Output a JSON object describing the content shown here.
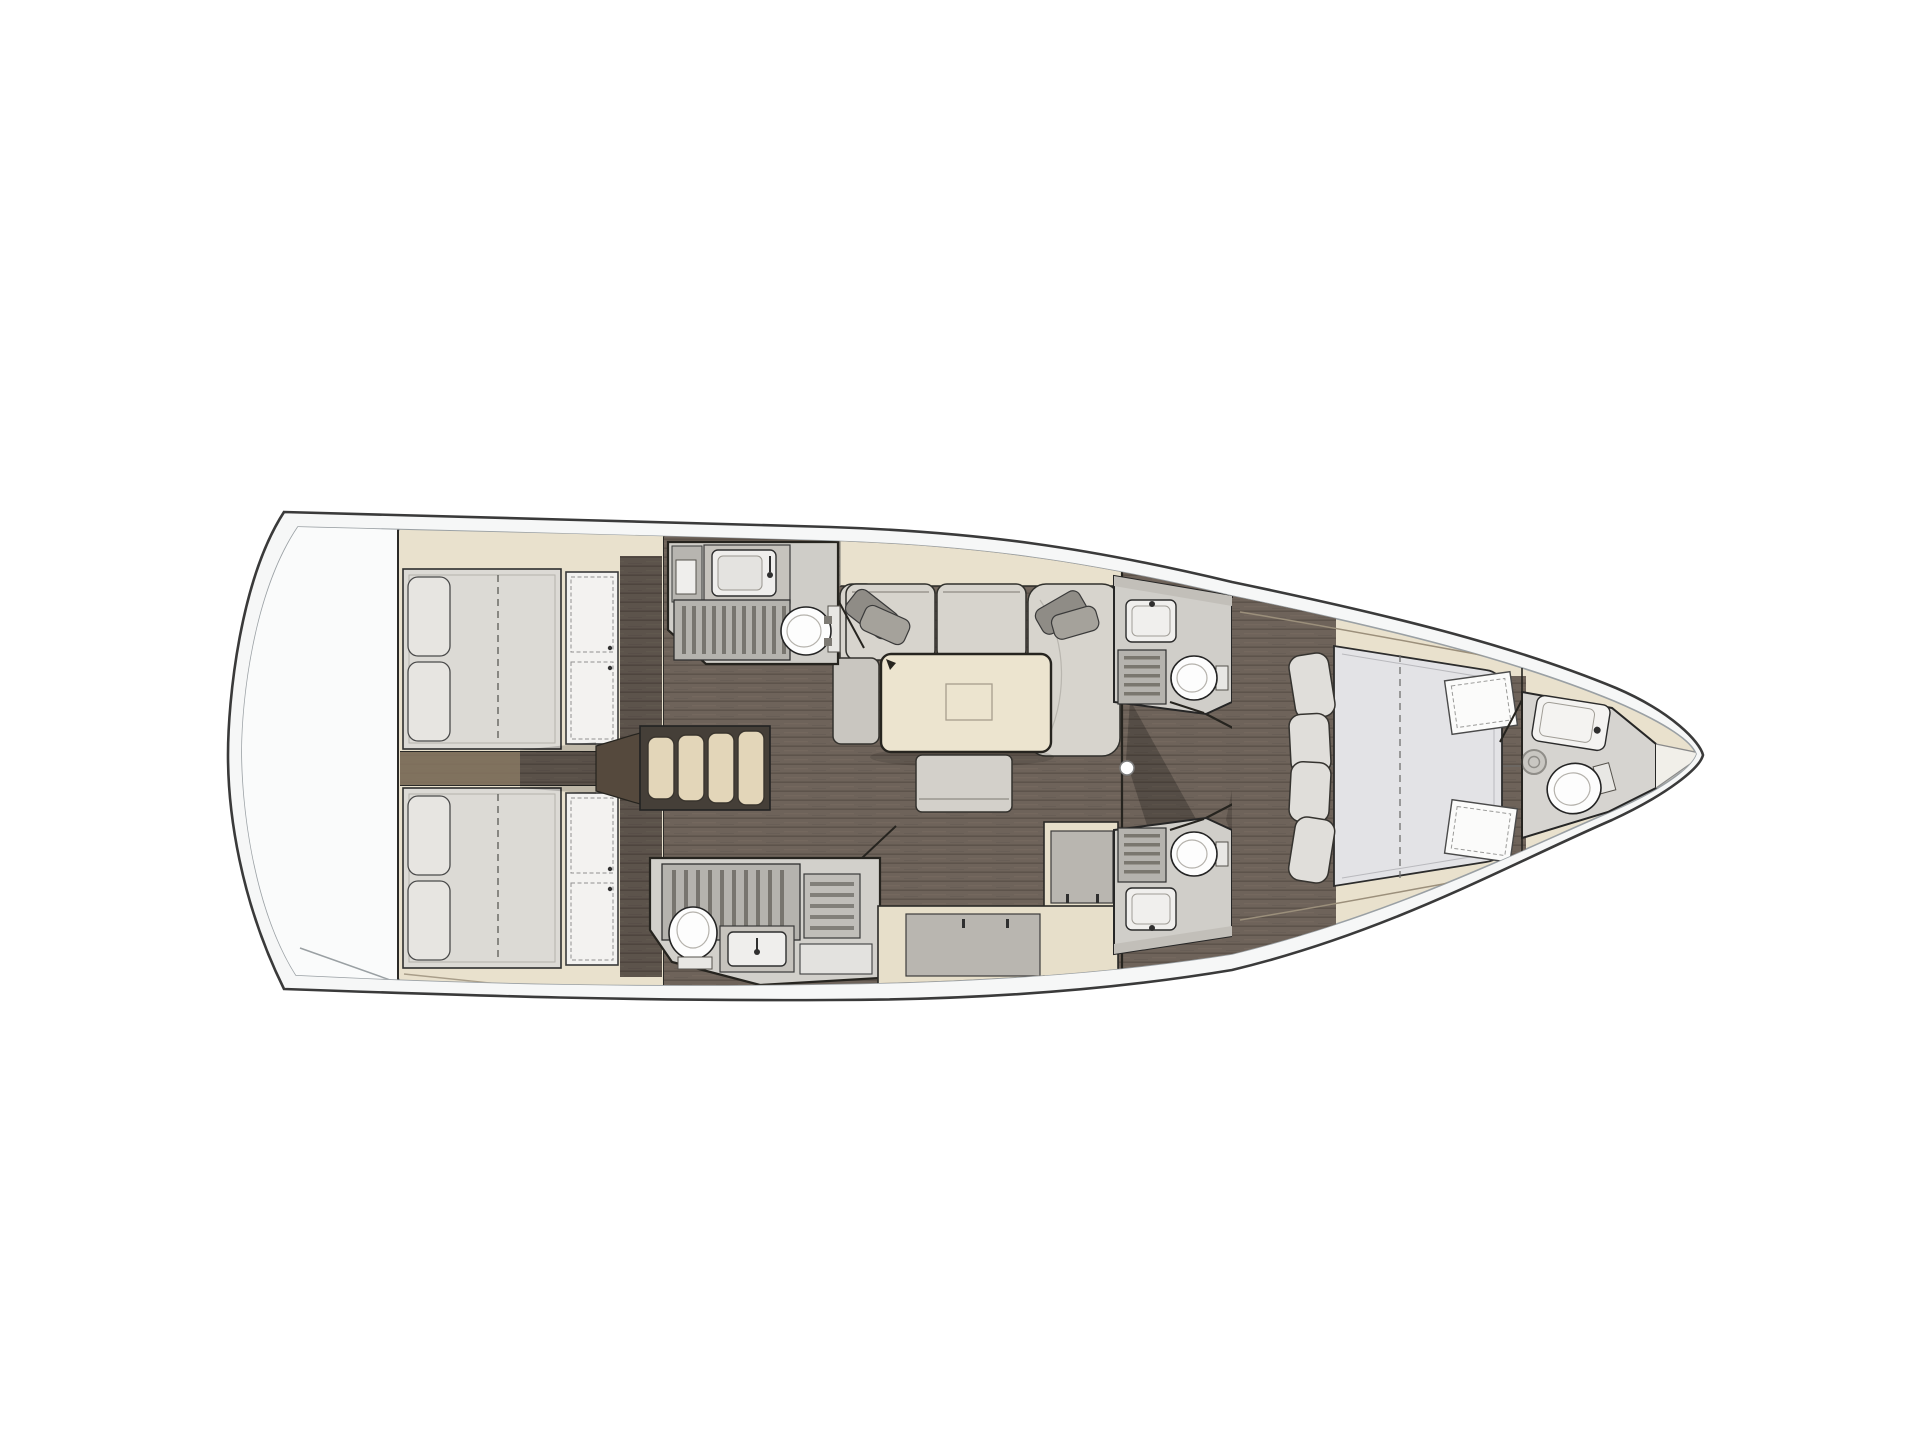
{
  "title": "Sailing yacht interior layout plan, top-down deck view, bow pointing right",
  "palette": {
    "hull_stroke": "#3a3a3a",
    "deck_band": "#f6f7f7",
    "joinery_beige": "#e9e1cd",
    "wood_floor": "#6e635a",
    "mattress_gray": "#dcdad5",
    "forward_mattress": "#e3e3e6",
    "sofa_fabric": "#d7d4cd",
    "table_top": "#ece4cf",
    "companionway_steps": "#e3d6b9",
    "shower_grate": "#b5b3ae",
    "sanitary_white": "#fdfdfd",
    "counter_gray": "#c3c0ba",
    "appliance_gray": "#b9b6b0"
  },
  "rooms": [
    {
      "id": "stern-lazarette",
      "label": "Stern / transom locker",
      "furniture": []
    },
    {
      "id": "aft-cabin-starboard",
      "label": "Aft double cabin, starboard",
      "furniture": [
        "double berth",
        "pillows",
        "wardrobe lockers"
      ]
    },
    {
      "id": "aft-cabin-port",
      "label": "Aft double cabin, port",
      "furniture": [
        "double berth",
        "pillows",
        "wardrobe lockers"
      ]
    },
    {
      "id": "companionway",
      "label": "Companionway steps",
      "furniture": [
        "four steps"
      ]
    },
    {
      "id": "aft-head-starboard",
      "label": "Aft head, starboard",
      "furniture": [
        "sink",
        "shower grate",
        "toilet"
      ]
    },
    {
      "id": "aft-head-port",
      "label": "Aft head with shower, port",
      "furniture": [
        "shower grate",
        "toilet",
        "sink",
        "locker"
      ]
    },
    {
      "id": "saloon",
      "label": "Saloon",
      "furniture": [
        "U-shaped sofa",
        "throw pillows",
        "dining table",
        "ottoman bench",
        "pouf seat"
      ]
    },
    {
      "id": "galley",
      "label": "Galley counters, port",
      "furniture": [
        "L-shaped counter",
        "appliance fronts"
      ]
    },
    {
      "id": "forward-vestibule",
      "label": "Forward vestibule",
      "furniture": [
        "door with round knob"
      ]
    },
    {
      "id": "forward-head-starboard",
      "label": "Forward head, starboard",
      "furniture": [
        "sink",
        "shower grate",
        "toilet"
      ]
    },
    {
      "id": "forward-head-port",
      "label": "Forward head, port",
      "furniture": [
        "sink",
        "shower grate",
        "toilet"
      ]
    },
    {
      "id": "owner-cabin",
      "label": "Forward owner cabin",
      "furniture": [
        "island double berth",
        "headboard cushions",
        "side shelves",
        "lockers"
      ]
    },
    {
      "id": "bow-head",
      "label": "Bow en-suite head",
      "furniture": [
        "sink",
        "toilet",
        "shower drain"
      ]
    },
    {
      "id": "bow-locker",
      "label": "Anchor / sail locker",
      "furniture": []
    }
  ]
}
